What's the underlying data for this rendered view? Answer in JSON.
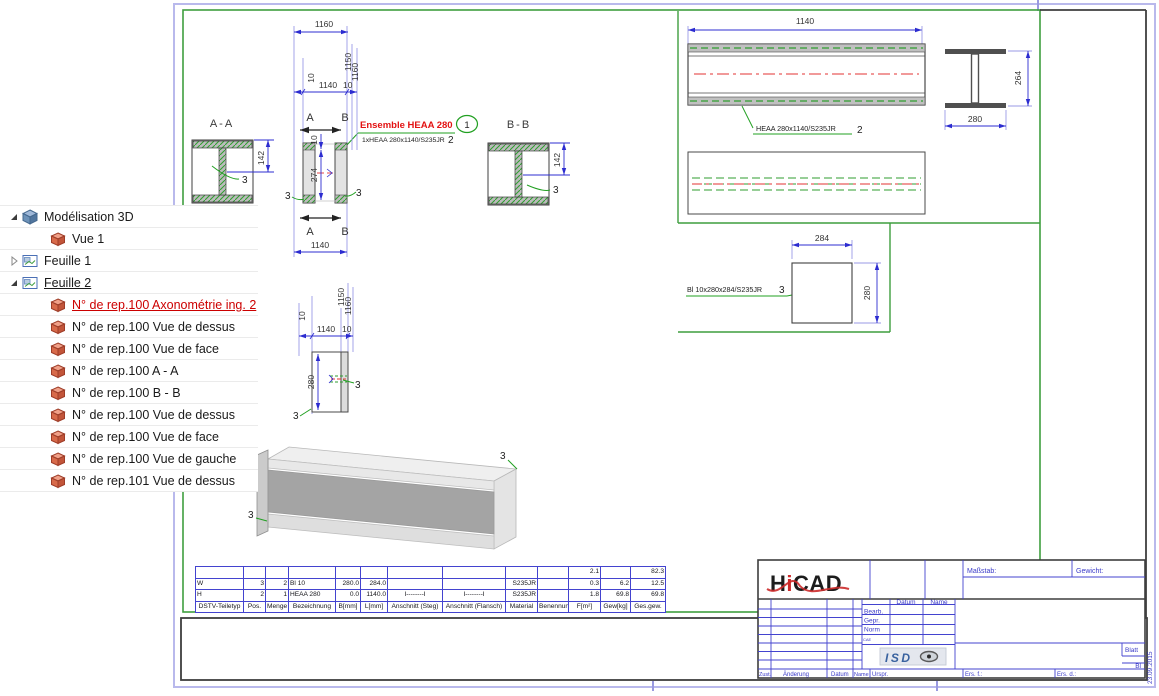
{
  "tree": {
    "items": [
      {
        "label": "Modélisation 3D",
        "level": 0,
        "expander": "expanded",
        "icon": "modeling-cube-icon",
        "style": "normal"
      },
      {
        "label": "Vue 1",
        "level": 1,
        "expander": "none",
        "icon": "view-cube-icon",
        "style": "normal"
      },
      {
        "label": "Feuille 1",
        "level": 0,
        "expander": "collapsed",
        "icon": "sheet-icon",
        "style": "normal"
      },
      {
        "label": "Feuille 2",
        "level": 0,
        "expander": "expanded",
        "icon": "sheet-icon",
        "style": "underline"
      },
      {
        "label": "N° de rep.100  Axonométrie ing. 2",
        "level": 1,
        "expander": "none",
        "icon": "part-icon",
        "style": "selected"
      },
      {
        "label": "N° de rep.100  Vue de dessus",
        "level": 1,
        "expander": "none",
        "icon": "part-icon",
        "style": "normal"
      },
      {
        "label": "N° de rep.100  Vue de face",
        "level": 1,
        "expander": "none",
        "icon": "part-icon",
        "style": "normal"
      },
      {
        "label": "N° de rep.100  A - A",
        "level": 1,
        "expander": "none",
        "icon": "part-icon",
        "style": "normal"
      },
      {
        "label": "N° de rep.100  B - B",
        "level": 1,
        "expander": "none",
        "icon": "part-icon",
        "style": "normal"
      },
      {
        "label": "N° de rep.100 Vue de dessus",
        "level": 1,
        "expander": "none",
        "icon": "part-icon",
        "style": "normal"
      },
      {
        "label": "N° de rep.100 Vue de face",
        "level": 1,
        "expander": "none",
        "icon": "part-icon",
        "style": "normal"
      },
      {
        "label": "N° de rep.100 Vue de gauche",
        "level": 1,
        "expander": "none",
        "icon": "part-icon",
        "style": "normal"
      },
      {
        "label": "N° de rep.101 Vue de dessus",
        "level": 1,
        "expander": "none",
        "icon": "part-icon",
        "style": "normal"
      }
    ]
  },
  "drawing": {
    "section_a_label": "A-A",
    "section_b_label": "B-B",
    "marker_a": "A",
    "marker_b": "B",
    "item_ref": "3",
    "assembly": {
      "title": "Ensemble HEAA 280",
      "balloon": "1",
      "part_line": "1xHEAA 280x1140/S235JR",
      "part_pos": "2"
    },
    "beam": {
      "label": "HEAA 280x1140/S235JR",
      "pos": "2"
    },
    "plate": {
      "label": "Bl 10x280x284/S235JR",
      "pos": "3"
    },
    "dims": {
      "d10": "10",
      "d142": "142",
      "d264": "264",
      "d274": "274",
      "d280": "280",
      "d284": "284",
      "d1140": "1140",
      "d1150": "1150",
      "d1160": "1160"
    }
  },
  "parts_table": {
    "headers": [
      "DSTV-Teiletyp",
      "Pos.",
      "Menge",
      "Bezeichnung",
      "B[mm]",
      "L[mm]",
      "Anschnitt (Steg)",
      "Anschnitt (Flansch)",
      "Material",
      "Benennung",
      "F[m²]",
      "Gew[kg]",
      "Ges.gew."
    ],
    "rows": [
      [
        "",
        "",
        "",
        "",
        "",
        "",
        "",
        "",
        "",
        "",
        "2.1",
        "",
        "82.3"
      ],
      [
        "W",
        "3",
        "2",
        "Bl 10",
        "280.0",
        "284.0",
        "",
        "",
        "S235JR",
        "",
        "0.3",
        "6.2",
        "12.5"
      ],
      [
        "H",
        "2",
        "1",
        "HEAA 280",
        "0.0",
        "1140.0",
        "I--------I",
        "I--------I",
        "S235JR",
        "",
        "1.8",
        "69.8",
        "69.8"
      ]
    ]
  },
  "title_block": {
    "logo_parts": [
      "H",
      "i",
      "CAD"
    ],
    "masstab": "Maßstab:",
    "gewicht": "Gewicht:",
    "datum": "Datum",
    "name": "Name",
    "bearb": "Bearb.",
    "gepr": "Gepr.",
    "norm": "Norm",
    "cae": "CAE",
    "isd_logo": "ISD",
    "blatt": "Blatt",
    "bl": "Bl",
    "zust": "Zust.",
    "aenderung": "Änderung",
    "datum2": "Datum",
    "name2": "Name",
    "urspr": "Urspr.",
    "ers_f": "Ers. f.:",
    "ers_d": "Ers. d.:",
    "date_vertical": "23.09.2015"
  },
  "colors": {
    "frame_blue": "#b9b9ec",
    "frame_green": "#3f9e3f",
    "dim_blue": "#2c2cd0",
    "ext_blue": "#9a9ae6",
    "highlight_red": "#e31212",
    "leader_green": "#22a022",
    "selected_red": "#cc0000",
    "table_border_blue": "#4343cf",
    "centerline_red": "#e33333"
  }
}
